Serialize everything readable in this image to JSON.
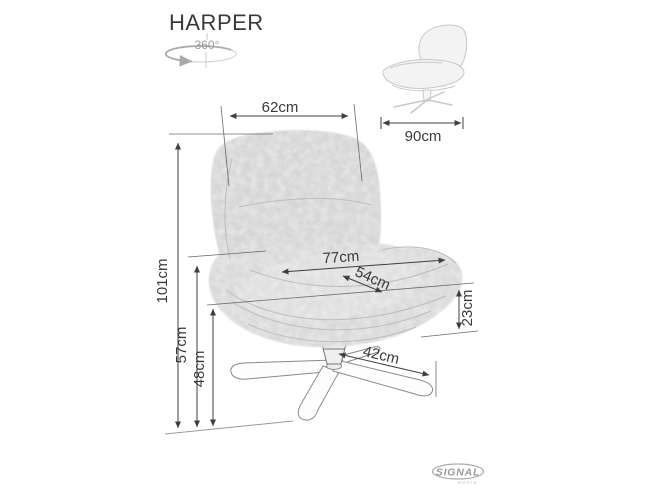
{
  "title": "HARPER",
  "rotation": {
    "label": "360°",
    "icon": "rotate-360-icon"
  },
  "dimensions": {
    "back_width": "62cm",
    "depth": "90cm",
    "total_height": "101cm",
    "overall_width": "77cm",
    "seat_width": "54cm",
    "armrest_height": "57cm",
    "seat_height": "48cm",
    "seat_edge_height": "23cm",
    "base_span": "42cm"
  },
  "brand": {
    "name": "SIGNAL",
    "tagline": "meble",
    "icon": "signal-logo"
  },
  "colors": {
    "background": "#ffffff",
    "dimension_line": "#3f3f3f",
    "extension_line": "#6a6a6a",
    "chair_fabric": "#d7d7d7",
    "chair_fabric_light": "#e3e3e3",
    "seam_line": "#bdbdbd",
    "thumbnail_outline": "#c8c8c8",
    "logo_gray": "#9a9a9a"
  }
}
